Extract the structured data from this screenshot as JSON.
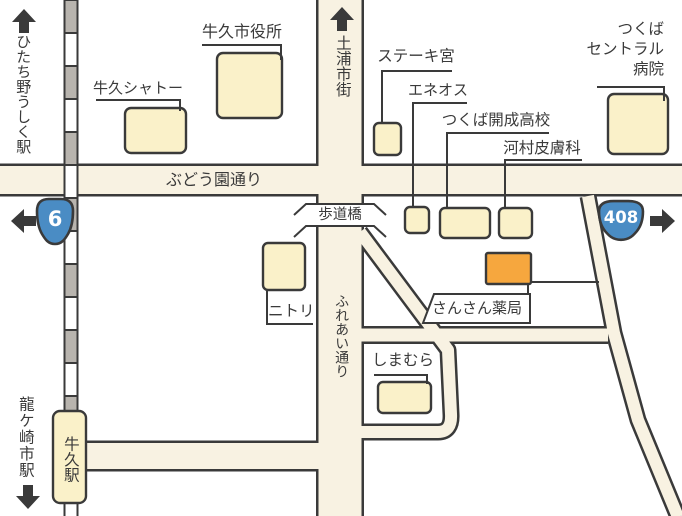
{
  "map": {
    "colors": {
      "road": "#f8f2e2",
      "building": "#faf1c9",
      "highlight": "#f6a73e",
      "rail": "#b8b4ae",
      "line": "#3a3a3a",
      "badge": "#4a8cc4",
      "white": "#ffffff"
    },
    "stations": {
      "hitachino_ushiku": "ひたち野うしく駅",
      "ushiku": "牛久駅",
      "ryugasaki_shi": "龍ケ崎市駅"
    },
    "directions": {
      "tsuchiura": "土浦市街"
    },
    "streets": {
      "budouen": "ぶどう園通り",
      "fureai": "ふれあい通り"
    },
    "bridge": {
      "hodokyo": "歩道橋"
    },
    "routes": {
      "route6": "6",
      "route408": "408"
    },
    "places": {
      "city_hall": "牛久市役所",
      "chateau": "牛久シャトー",
      "steak_miya": "ステーキ宮",
      "eneos": "エネオス",
      "kaisei_hs": "つくば開成高校",
      "kawamura_derm": "河村皮膚科",
      "central_hospital": "つくば\nセントラル\n病院",
      "nitori": "ニトリ",
      "sansan_pharmacy": "さんさん薬局",
      "shimamura": "しまむら"
    }
  }
}
